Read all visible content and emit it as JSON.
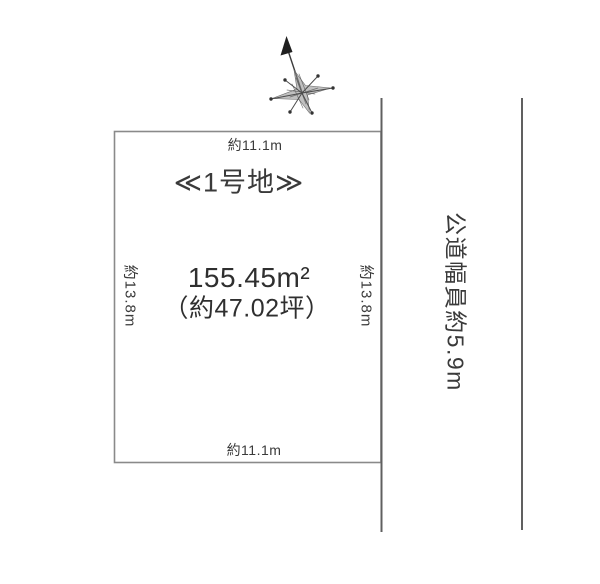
{
  "diagram": {
    "lot": {
      "title": "≪1号地≫",
      "area_m2": "155.45m²",
      "area_tsubo": "（約47.02坪）",
      "dim_top": "約11.1m",
      "dim_bottom": "約11.1m",
      "dim_left": "約13.8m",
      "dim_right": "約13.8m"
    },
    "road": {
      "label": "公道幅員約5.9m"
    },
    "icons": {
      "compass": "north-arrow-compass"
    },
    "colors": {
      "background": "#ffffff",
      "plot_line": "#8a8a8a",
      "road_line": "#606060",
      "text": "#3a3a3a",
      "compass_ink": "#3c3c3c"
    }
  }
}
